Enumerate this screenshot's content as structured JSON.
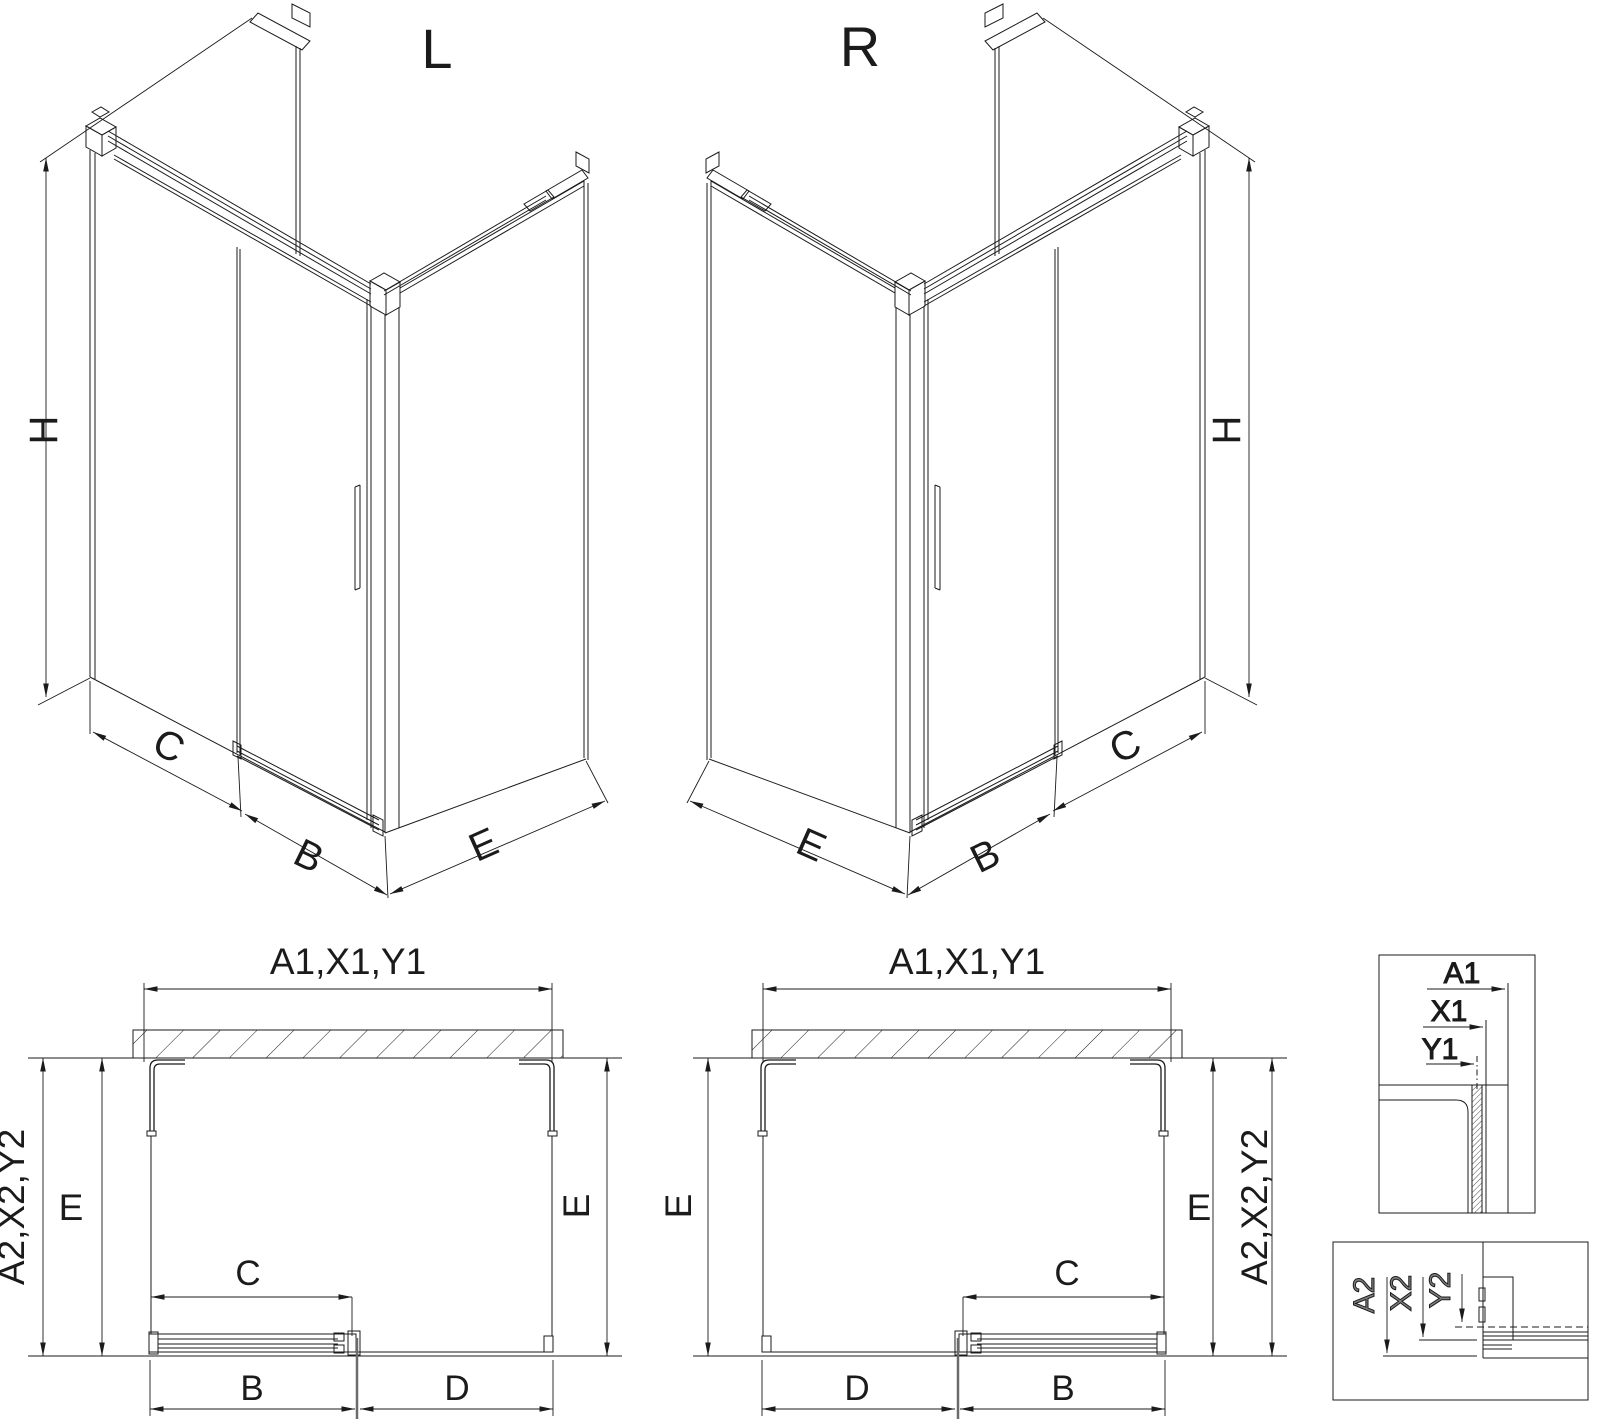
{
  "drawing": {
    "type": "shower-enclosure-technical-drawing",
    "views": {
      "iso_left": {
        "title": "L",
        "dim_height": "H",
        "dim_panel": "C",
        "dim_door": "B",
        "dim_side": "E"
      },
      "iso_right": {
        "title": "R",
        "dim_height": "H",
        "dim_panel": "C",
        "dim_door": "B",
        "dim_side": "E"
      },
      "plan_left": {
        "dim_total_width": "A1,X1,Y1",
        "dim_total_depth": "A2,X2,Y2",
        "dim_depth_left": "E",
        "dim_depth_right": "E",
        "dim_slide": "C",
        "dim_door_width": "B",
        "dim_panel_width": "D"
      },
      "plan_right": {
        "dim_total_width": "A1,X1,Y1",
        "dim_total_depth": "A2,X2,Y2",
        "dim_depth_left": "E",
        "dim_depth_right": "E",
        "dim_slide": "C",
        "dim_door_width": "B",
        "dim_panel_width": "D"
      },
      "detail_top_right": {
        "dim_a": "A1",
        "dim_x": "X1",
        "dim_y": "Y1"
      },
      "detail_bottom_right": {
        "dim_a": "A2",
        "dim_x": "X2",
        "dim_y": "Y2"
      }
    },
    "colors": {
      "line": "#1b1b1b",
      "glass_edge": "#6b6b6b",
      "detail_label_gray": "#7e7e7e",
      "background": "#ffffff"
    }
  }
}
